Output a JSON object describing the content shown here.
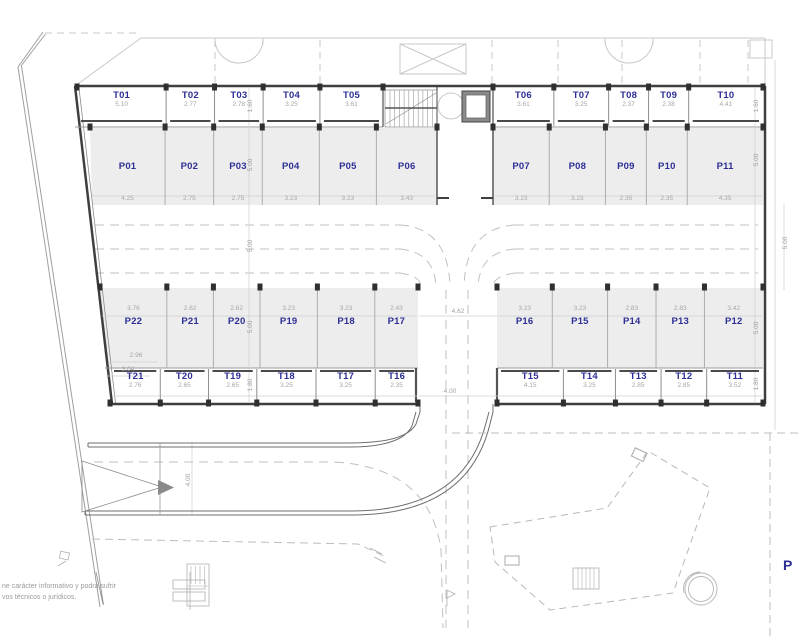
{
  "plan_title": "Parking / trasteros floor plan",
  "colors": {
    "unit_label": "#2d2f96",
    "dimension_text": "#a6a6a6",
    "parking_fill": "#ededed",
    "wall": "#3f3f3f",
    "light_outline": "#c8c8c8"
  },
  "building": {
    "top_storage_left": [
      {
        "id": "T01",
        "w": "5.10"
      },
      {
        "id": "T02",
        "w": "2.77"
      },
      {
        "id": "T03",
        "w": "2.78"
      },
      {
        "id": "T04",
        "w": "3.25"
      },
      {
        "id": "T05",
        "w": "3.61"
      }
    ],
    "top_storage_right": [
      {
        "id": "T06",
        "w": "3.61"
      },
      {
        "id": "T07",
        "w": "3.25"
      },
      {
        "id": "T08",
        "w": "2.37"
      },
      {
        "id": "T09",
        "w": "2.38"
      },
      {
        "id": "T10",
        "w": "4.41"
      }
    ],
    "top_parking_left": [
      {
        "id": "P01",
        "w": "4.25"
      },
      {
        "id": "P02",
        "w": "2.75"
      },
      {
        "id": "P03",
        "w": "2.75"
      },
      {
        "id": "P04",
        "w": "3.23"
      },
      {
        "id": "P05",
        "w": "3.23"
      },
      {
        "id": "P06",
        "w": "3.43"
      }
    ],
    "top_parking_right": [
      {
        "id": "P07",
        "w": "3.23"
      },
      {
        "id": "P08",
        "w": "3.23"
      },
      {
        "id": "P09",
        "w": "2.35"
      },
      {
        "id": "P10",
        "w": "2.35"
      },
      {
        "id": "P11",
        "w": "4.35"
      }
    ],
    "bottom_parking_left": [
      {
        "id": "P22",
        "w": "3.76"
      },
      {
        "id": "P21",
        "w": "2.62"
      },
      {
        "id": "P20",
        "w": "2.62"
      },
      {
        "id": "P19",
        "w": "3.23"
      },
      {
        "id": "P18",
        "w": "3.23"
      },
      {
        "id": "P17",
        "w": "2.43"
      }
    ],
    "bottom_parking_right": [
      {
        "id": "P16",
        "w": "3.23"
      },
      {
        "id": "P15",
        "w": "3.23"
      },
      {
        "id": "P14",
        "w": "2.83"
      },
      {
        "id": "P13",
        "w": "2.83"
      },
      {
        "id": "P12",
        "w": "3.42"
      }
    ],
    "bottom_storage_left": [
      {
        "id": "T21",
        "w": "2.76"
      },
      {
        "id": "T20",
        "w": "2.65"
      },
      {
        "id": "T19",
        "w": "2.65"
      },
      {
        "id": "T18",
        "w": "3.25"
      },
      {
        "id": "T17",
        "w": "3.25"
      },
      {
        "id": "T16",
        "w": "2.35"
      }
    ],
    "bottom_storage_right": [
      {
        "id": "T15",
        "w": "4.15"
      },
      {
        "id": "T14",
        "w": "3.25"
      },
      {
        "id": "T13",
        "w": "2.85"
      },
      {
        "id": "T12",
        "w": "2.85"
      },
      {
        "id": "T11",
        "w": "3.52"
      }
    ],
    "p22_extra_dims": [
      "2.96",
      "3.04"
    ]
  },
  "dimensions": {
    "left_chain": [
      "1.60",
      "5.00",
      "5.00",
      "5.00",
      "1.80"
    ],
    "right_chain": [
      "1.60",
      "5.00",
      "5.00",
      "1.80"
    ],
    "right_outer_aisle": "5.00",
    "central_road_top": "4.62",
    "central_road_bottom": "4.00",
    "ramp": "4.00"
  },
  "disclaimer": {
    "line1": "ne carácter informativo y podrá sufrir",
    "line2": "vos técnicos o jurídicos."
  },
  "partial_label": "P"
}
